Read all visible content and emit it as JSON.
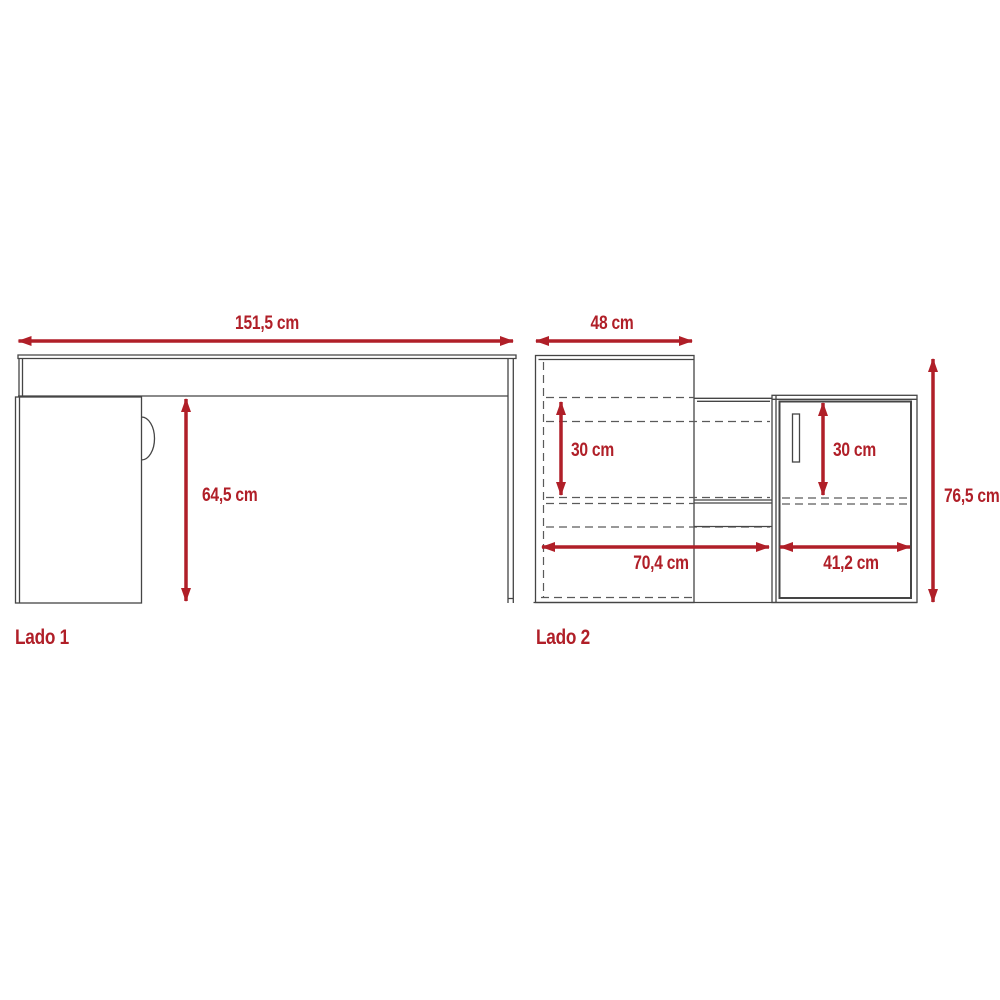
{
  "views": {
    "lado1": {
      "label": "Lado 1",
      "width": "151,5 cm",
      "height": "64,5 cm"
    },
    "lado2": {
      "label": "Lado 2",
      "depth": "48 cm",
      "height": "76,5 cm",
      "left_width": "70,4 cm",
      "right_width": "41,2 cm",
      "left_shelf": "30 cm",
      "right_shelf": "30 cm"
    }
  },
  "colors": {
    "dimension_red": "#B01F28",
    "outline_dark": "#454545",
    "background": "#FFFFFF"
  }
}
